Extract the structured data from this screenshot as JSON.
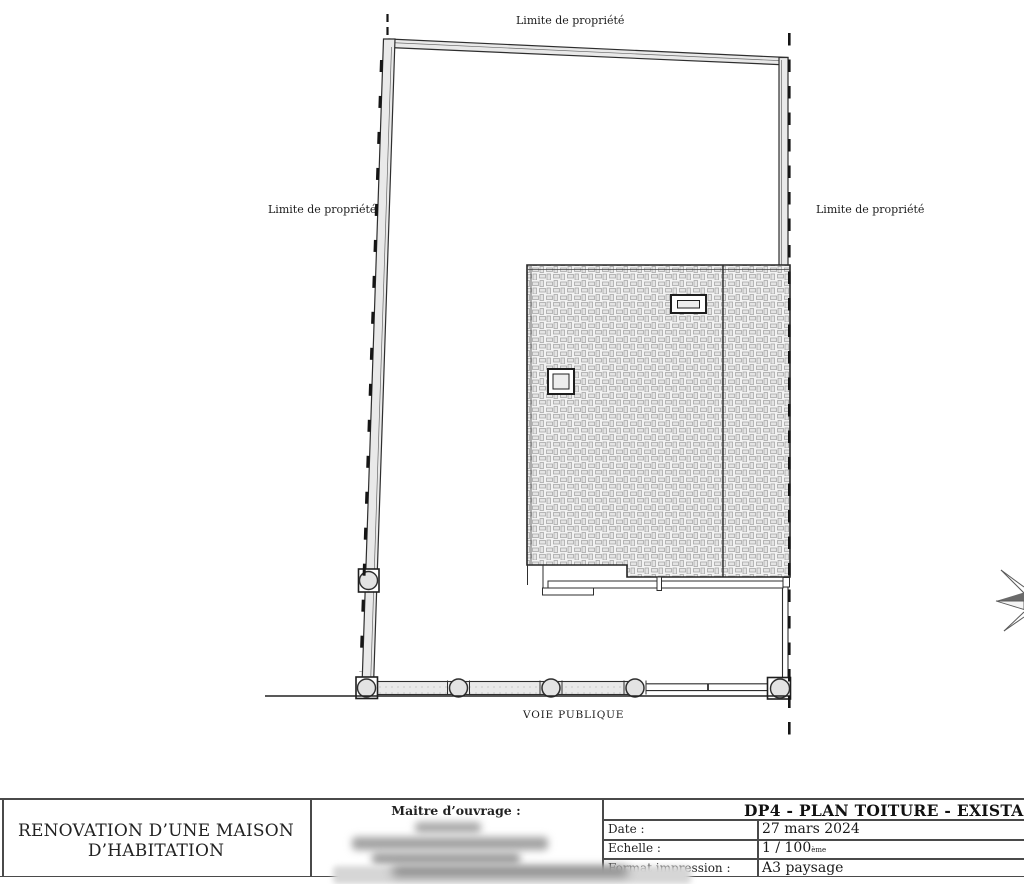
{
  "plan": {
    "boundary_label_top": "Limite de propriété",
    "boundary_label_left": "Limite de propriété",
    "boundary_label_right": "Limite de propriété",
    "road_label": "VOIE PUBLIQUE",
    "colors": {
      "line": "#2e2e2e",
      "wall_fill": "#e9e9e9",
      "hatch_tone": "#e3e3e3"
    }
  },
  "title_block": {
    "project_title_line1": "RENOVATION D’UNE MAISON",
    "project_title_line2": "D’HABITATION",
    "owner_label": "Maitre d’ouvrage :",
    "drawing_title": "DP4 - PLAN TOITURE - EXISTANT",
    "fields": [
      {
        "label": "Date :",
        "value": "27 mars 2024",
        "suffix": ""
      },
      {
        "label": "Echelle :",
        "value": "1 / 100",
        "suffix": "ème"
      },
      {
        "label": "Format impression :",
        "value": "A3 paysage",
        "suffix": ""
      }
    ]
  }
}
